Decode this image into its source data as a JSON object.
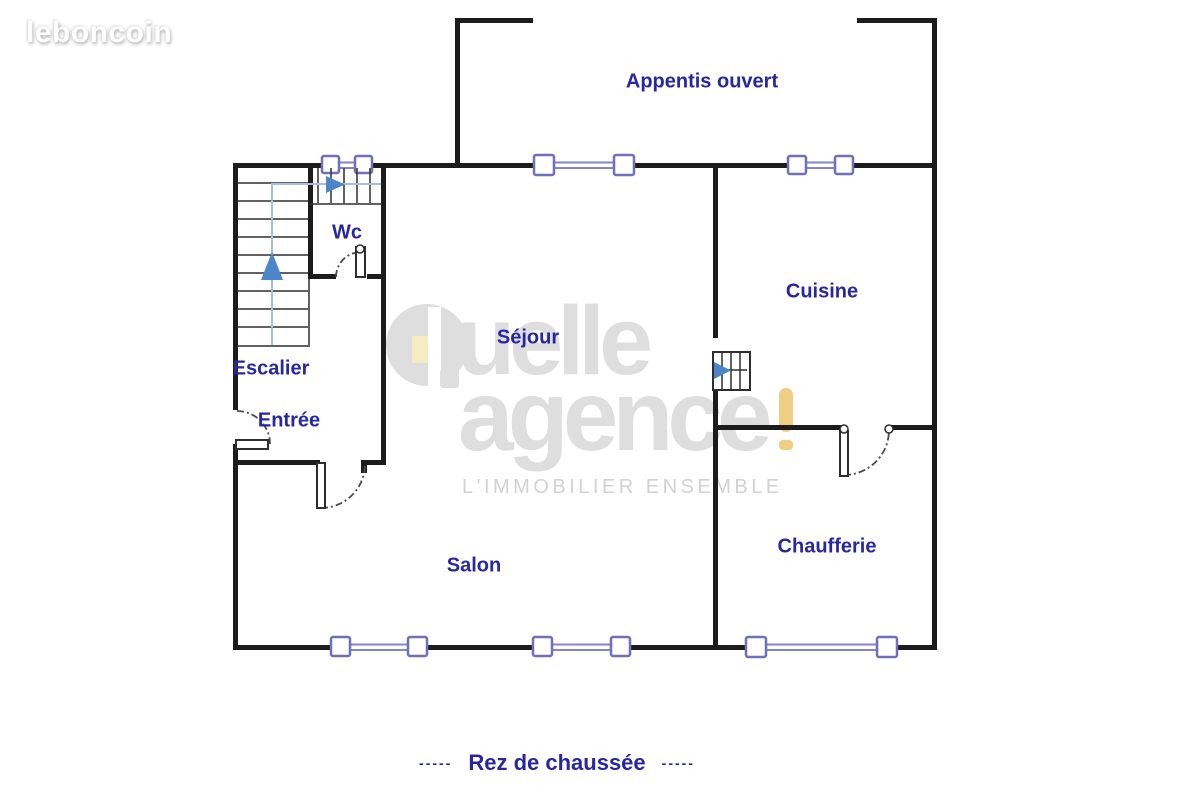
{
  "logo": {
    "text": "leboncoin"
  },
  "watermark": {
    "word1": "uelle",
    "word2": "agence",
    "exclamation": "!",
    "tagline": "L'IMMOBILIER ENSEMBLE",
    "full_brand": "Quelle agence !"
  },
  "floorplan": {
    "floor_caption": {
      "dashes_left": "-----",
      "text": "Rez de chaussée",
      "dashes_right": "-----"
    },
    "rooms": [
      {
        "id": "appentis",
        "label": "Appentis ouvert"
      },
      {
        "id": "wc",
        "label": "Wc"
      },
      {
        "id": "sejour",
        "label": "Séjour"
      },
      {
        "id": "cuisine",
        "label": "Cuisine"
      },
      {
        "id": "escalier",
        "label": "Escalier"
      },
      {
        "id": "entree",
        "label": "Entrée"
      },
      {
        "id": "salon",
        "label": "Salon"
      },
      {
        "id": "chaufferie",
        "label": "Chaufferie"
      }
    ],
    "symbols": [
      "stairs-up-arrow",
      "stairs-turn-right-arrow",
      "cellar-stairs-arrow",
      "window",
      "door-swing"
    ]
  },
  "theme": {
    "wall_color": "#1c1c1c",
    "line_color": "#2e2e2e",
    "window_color": "#6f6fba",
    "window_rail_color": "#8585cc",
    "arrow_color": "#4a86c8",
    "guide_color": "#a3bede",
    "door_color": "#4a4a4a",
    "label_color": "#2727a3",
    "watermark_gray": "#dedede",
    "watermark_yellow": "#eecf82",
    "tagline_gray": "#d2d2d2",
    "logo_color": "#ffffff"
  }
}
